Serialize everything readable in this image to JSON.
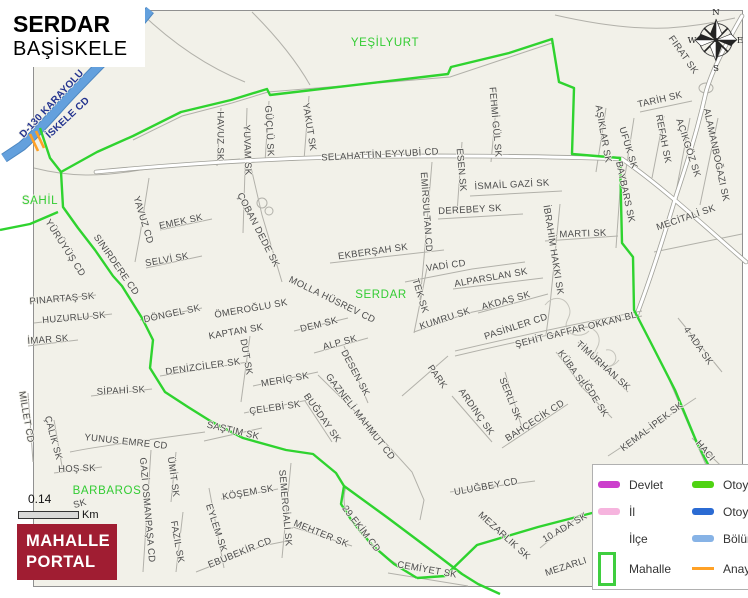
{
  "title": {
    "district_name": "SERDAR",
    "municipality": "BAŞİSKELE"
  },
  "colors": {
    "mapbg": "#f2f1e9",
    "boundary": "#2fd32f",
    "highway": "#63a0dd",
    "anayol": "#ffa126",
    "district": "#33cc33",
    "logo": "#a01d32"
  },
  "scale": {
    "value": "0.14",
    "unit": "Km"
  },
  "logo": {
    "line1": "MAHALLE",
    "line2": "PORTAL"
  },
  "compass": {
    "n": "N",
    "e": "E",
    "s": "S",
    "w": "W"
  },
  "legend": {
    "rows": [
      {
        "left": {
          "label": "Devlet",
          "swatch": "line",
          "color": "#cc3ecc"
        },
        "right": {
          "label": "Otoyol-YİD",
          "swatch": "line",
          "color": "#4fd312"
        }
      },
      {
        "left": {
          "label": "İl",
          "swatch": "line",
          "color": "#f6b4de"
        },
        "right": {
          "label": "Otoyol",
          "swatch": "line",
          "color": "#2b6bd3"
        }
      },
      {
        "left": {
          "label": "İlçe",
          "swatch": "none",
          "color": ""
        },
        "right": {
          "label": "Bölünmüş Y",
          "swatch": "line",
          "color": "#87b3e6"
        }
      },
      {
        "left": {
          "label": "Mahalle",
          "swatch": "box",
          "color": "#3fce3f"
        },
        "right": {
          "label": "Anayol",
          "swatch": "thin",
          "color": "#ffa126"
        }
      }
    ]
  },
  "map": {
    "labels": [
      {
        "t": "YEŞİLYURT",
        "x": 385,
        "y": 43,
        "r": 0,
        "c": "area"
      },
      {
        "t": "SAHİL",
        "x": 40,
        "y": 201,
        "r": 0,
        "c": "area"
      },
      {
        "t": "SERDAR",
        "x": 381,
        "y": 295,
        "r": 0,
        "c": "area"
      },
      {
        "t": "BARBAROS",
        "x": 107,
        "y": 491,
        "r": 0,
        "c": "area"
      },
      {
        "t": "D-130 KARAYOLU",
        "x": 52,
        "y": 104,
        "r": -47,
        "c": "hwy"
      },
      {
        "t": "İSKELE CD",
        "x": 68,
        "y": 118,
        "r": -43,
        "c": "hwy"
      },
      {
        "t": "HAVUZ SK",
        "x": 220,
        "y": 136,
        "r": 90
      },
      {
        "t": "YUVAM SK",
        "x": 247,
        "y": 150,
        "r": 88
      },
      {
        "t": "GÜÇLÜ SK",
        "x": 269,
        "y": 131,
        "r": 87
      },
      {
        "t": "YAKUT SK",
        "x": 309,
        "y": 127,
        "r": 81
      },
      {
        "t": "SELAHATTİN EYYUBİ CD",
        "x": 380,
        "y": 155,
        "r": -3
      },
      {
        "t": "FEHMİ GÜL SK",
        "x": 495,
        "y": 122,
        "r": 85
      },
      {
        "t": "ESEN SK",
        "x": 461,
        "y": 170,
        "r": 85
      },
      {
        "t": "EMİRSULTAN CD",
        "x": 426,
        "y": 212,
        "r": 86
      },
      {
        "t": "İSMAİL GAZİ SK",
        "x": 512,
        "y": 185,
        "r": -3
      },
      {
        "t": "DEREBEY SK",
        "x": 470,
        "y": 210,
        "r": -3
      },
      {
        "t": "MARTI SK",
        "x": 583,
        "y": 234,
        "r": -2
      },
      {
        "t": "İBRAHİM HAKKI SK",
        "x": 553,
        "y": 250,
        "r": 81
      },
      {
        "t": "BAYBARS SK",
        "x": 625,
        "y": 192,
        "r": 78
      },
      {
        "t": "AŞIKLAR SK",
        "x": 603,
        "y": 134,
        "r": 80
      },
      {
        "t": "UFUK SK",
        "x": 628,
        "y": 148,
        "r": 73
      },
      {
        "t": "TARİH SK",
        "x": 660,
        "y": 100,
        "r": -13
      },
      {
        "t": "FIRAT SK",
        "x": 683,
        "y": 55,
        "r": 55
      },
      {
        "t": "REFAH SK",
        "x": 663,
        "y": 139,
        "r": 79
      },
      {
        "t": "AÇIKGÖZ SK",
        "x": 688,
        "y": 148,
        "r": 72
      },
      {
        "t": "ALAMANBOĞAZI SK",
        "x": 716,
        "y": 155,
        "r": 78
      },
      {
        "t": "MECİTALİ SK",
        "x": 686,
        "y": 218,
        "r": -19
      },
      {
        "t": "4 ADA SK",
        "x": 698,
        "y": 346,
        "r": 55
      },
      {
        "t": "YÜRÜYÜŞ CD",
        "x": 65,
        "y": 248,
        "r": 57
      },
      {
        "t": "SINIRDERE CD",
        "x": 116,
        "y": 265,
        "r": 55
      },
      {
        "t": "YAVUZ CD",
        "x": 143,
        "y": 220,
        "r": 73
      },
      {
        "t": "EMEK SK",
        "x": 181,
        "y": 222,
        "r": -12
      },
      {
        "t": "SELVİ SK",
        "x": 167,
        "y": 260,
        "r": -10
      },
      {
        "t": "ÇOBAN DEDE SK",
        "x": 258,
        "y": 230,
        "r": 63
      },
      {
        "t": "EKBERŞAH SK",
        "x": 373,
        "y": 252,
        "r": -8
      },
      {
        "t": "VADİ CD",
        "x": 446,
        "y": 266,
        "r": -8
      },
      {
        "t": "TEK SK",
        "x": 420,
        "y": 296,
        "r": 73
      },
      {
        "t": "ALPARSLAN SK",
        "x": 491,
        "y": 278,
        "r": -10
      },
      {
        "t": "KUMRU SK",
        "x": 445,
        "y": 319,
        "r": -18
      },
      {
        "t": "AKDAŞ SK",
        "x": 506,
        "y": 301,
        "r": -15
      },
      {
        "t": "PASİNLER CD",
        "x": 516,
        "y": 327,
        "r": -18
      },
      {
        "t": "ŞEHİT GAFFAR OKKAN BL",
        "x": 576,
        "y": 330,
        "r": -14
      },
      {
        "t": "TİMURHAN SK",
        "x": 603,
        "y": 366,
        "r": 42
      },
      {
        "t": "KÜBA SK",
        "x": 572,
        "y": 369,
        "r": 55
      },
      {
        "t": "İĞDE SK",
        "x": 595,
        "y": 399,
        "r": 58
      },
      {
        "t": "SERLİ SK",
        "x": 510,
        "y": 399,
        "r": 68
      },
      {
        "t": "ARDINÇ SK",
        "x": 476,
        "y": 412,
        "r": 55
      },
      {
        "t": "BAHÇECİK CD",
        "x": 535,
        "y": 421,
        "r": -33
      },
      {
        "t": "PARK",
        "x": 437,
        "y": 377,
        "r": 55
      },
      {
        "t": "MOLLA HÜSREV CD",
        "x": 332,
        "y": 300,
        "r": 26
      },
      {
        "t": "ÖMEROĞLU SK",
        "x": 251,
        "y": 309,
        "r": -10
      },
      {
        "t": "KAPTAN SK",
        "x": 236,
        "y": 332,
        "r": -10
      },
      {
        "t": "DUT SK",
        "x": 246,
        "y": 357,
        "r": 80
      },
      {
        "t": "DEM SK",
        "x": 319,
        "y": 325,
        "r": -14
      },
      {
        "t": "ALP SK",
        "x": 340,
        "y": 343,
        "r": -15
      },
      {
        "t": "DESEN SK",
        "x": 355,
        "y": 373,
        "r": 62
      },
      {
        "t": "PINARTAŞ SK",
        "x": 62,
        "y": 299,
        "r": -5
      },
      {
        "t": "HUZURLU SK",
        "x": 74,
        "y": 318,
        "r": -5
      },
      {
        "t": "İMAR SK",
        "x": 48,
        "y": 340,
        "r": -4
      },
      {
        "t": "DÖNGEL SK",
        "x": 172,
        "y": 314,
        "r": -12
      },
      {
        "t": "DENİZCİLER SK",
        "x": 203,
        "y": 367,
        "r": -8
      },
      {
        "t": "SİPAHİ SK",
        "x": 121,
        "y": 391,
        "r": -3
      },
      {
        "t": "MİLLET CD",
        "x": 26,
        "y": 417,
        "r": 80
      },
      {
        "t": "ÇALIK SK",
        "x": 53,
        "y": 438,
        "r": 75
      },
      {
        "t": "YUNUS EMRE CD",
        "x": 126,
        "y": 442,
        "r": 6
      },
      {
        "t": "HOŞ SK",
        "x": 77,
        "y": 469,
        "r": -2
      },
      {
        "t": "SAŞTIM SK",
        "x": 233,
        "y": 431,
        "r": 13
      },
      {
        "t": "GAZİ OSMANPAŞA CD",
        "x": 147,
        "y": 510,
        "r": 85
      },
      {
        "t": "ÜMİT SK",
        "x": 173,
        "y": 477,
        "r": 82
      },
      {
        "t": "FAZIL SK",
        "x": 177,
        "y": 542,
        "r": 80
      },
      {
        "t": "EYLEM SK",
        "x": 216,
        "y": 528,
        "r": 72
      },
      {
        "t": "KÖŞEM SK",
        "x": 248,
        "y": 493,
        "r": -10
      },
      {
        "t": "SEMERCİALİ SK",
        "x": 285,
        "y": 508,
        "r": 85
      },
      {
        "t": "MEHTER SK",
        "x": 321,
        "y": 534,
        "r": 22
      },
      {
        "t": "EBUBEKİR CD",
        "x": 240,
        "y": 553,
        "r": -22
      },
      {
        "t": "29 EKİM CD",
        "x": 361,
        "y": 529,
        "r": 52
      },
      {
        "t": "CEMİYET SK",
        "x": 427,
        "y": 570,
        "r": 10
      },
      {
        "t": "GAZNELİ MAHMUT CD",
        "x": 360,
        "y": 417,
        "r": 52
      },
      {
        "t": "BUĞDAY SK",
        "x": 322,
        "y": 418,
        "r": 55
      },
      {
        "t": "ÇELEBİ SK",
        "x": 275,
        "y": 408,
        "r": -8
      },
      {
        "t": "MERİÇ SK",
        "x": 285,
        "y": 380,
        "r": -10
      },
      {
        "t": "MEZARLIK SK",
        "x": 504,
        "y": 536,
        "r": 42
      },
      {
        "t": "10 ADA SK",
        "x": 565,
        "y": 528,
        "r": -30
      },
      {
        "t": "MEZARLI",
        "x": 566,
        "y": 567,
        "r": -18
      },
      {
        "t": "KEMAL İPEK SK",
        "x": 652,
        "y": 427,
        "r": -37
      },
      {
        "t": "HACI",
        "x": 705,
        "y": 451,
        "r": 50
      },
      {
        "t": "ULUĞBEY CD",
        "x": 486,
        "y": 487,
        "r": -10
      },
      {
        "t": "SK",
        "x": 80,
        "y": 504,
        "r": -15
      }
    ]
  }
}
